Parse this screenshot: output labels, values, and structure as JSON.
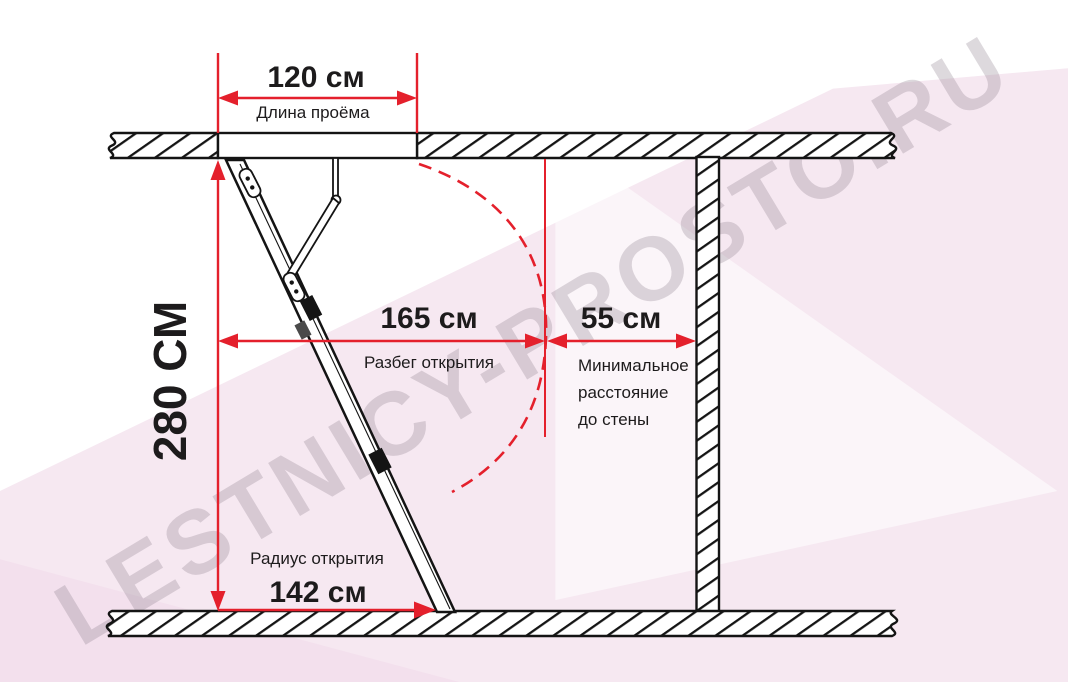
{
  "watermark": "LESTNICY-PROSTO.RU",
  "dimensions": {
    "opening_length": {
      "value": "120 см",
      "label": "Длина проёма"
    },
    "room_height": {
      "value": "280 СМ"
    },
    "opening_run": {
      "value": "165 см",
      "label": "Разбег открытия"
    },
    "min_wall_distance": {
      "value": "55 см",
      "label_line1": "Минимальное",
      "label_line2": "расстояние",
      "label_line3": "до стены"
    },
    "opening_radius": {
      "value": "142 см",
      "label": "Радиус открытия"
    }
  },
  "colors": {
    "dimension_red": "#e4202c",
    "drawing_black": "#141414",
    "text_black": "#1d1b1c",
    "background_pink": "#f6e8f1",
    "watermark_gray": "#9a8e9a"
  }
}
